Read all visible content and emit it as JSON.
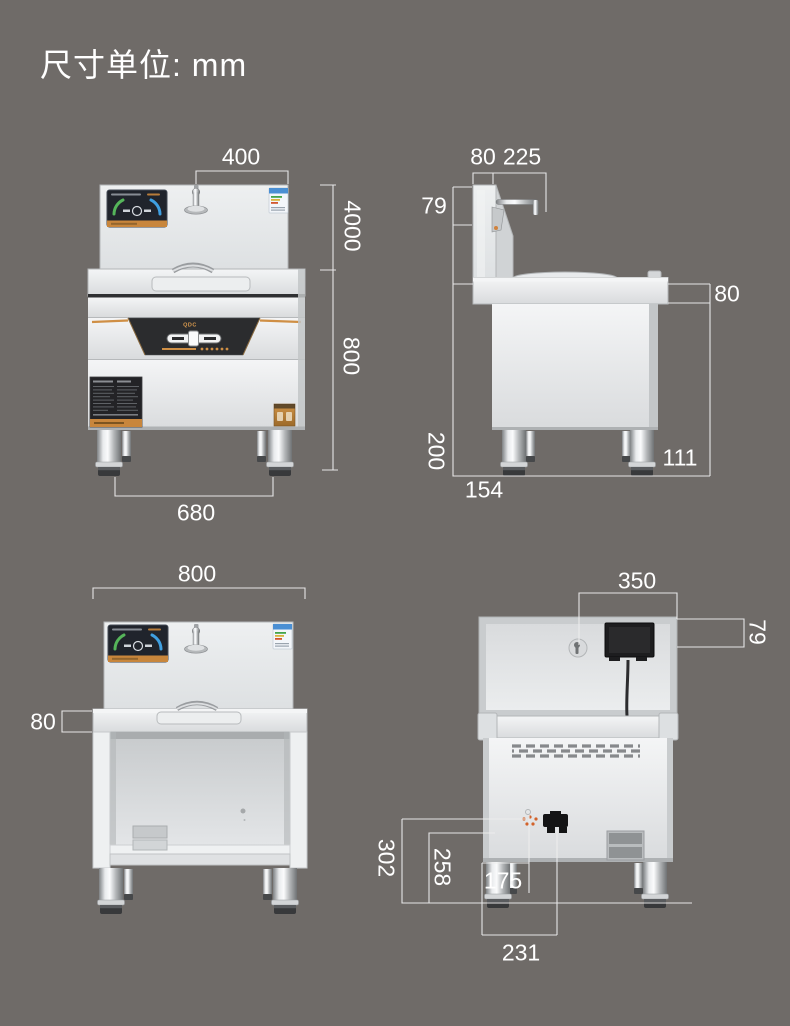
{
  "page": {
    "title": "尺寸单位: mm",
    "unit": "mm",
    "background_color": "#6f6b68",
    "dimension_line_color": "#ededed",
    "dimension_text_color": "#ffffff",
    "accent_orange": "#c8863c"
  },
  "brand": {
    "control_panel_logo": "QDC"
  },
  "icons": {
    "faucet": "faucet-icon",
    "display_screen": "display-screen",
    "energy_label": "energy-label",
    "junction_box": "junction-box",
    "power_plug": "power-plug-icon",
    "water_inlet": "water-inlet-icon",
    "vent_grille": "vent-grille"
  },
  "views": {
    "front_view_stove": {
      "dims": {
        "faucet_span": "400",
        "backsplash_height": "4000",
        "body_height": "800",
        "leg_spacing": "680"
      }
    },
    "side_view": {
      "dims": {
        "backsplash_depth": "80",
        "faucet_reach": "225",
        "faucet_rise": "79",
        "countertop_thickness": "80",
        "leg_height": "200",
        "front_leg_inset": "154",
        "rear_leg_inset": "111"
      }
    },
    "front_view_stand": {
      "dims": {
        "overall_width": "800",
        "countertop_thickness": "80"
      }
    },
    "back_view": {
      "dims": {
        "junction_box_span": "350",
        "junction_box_height": "79",
        "water_inlet_height": "302",
        "mid_bracket_height": "258",
        "water_inlet_offset": "175",
        "power_cord_offset": "231"
      }
    }
  }
}
